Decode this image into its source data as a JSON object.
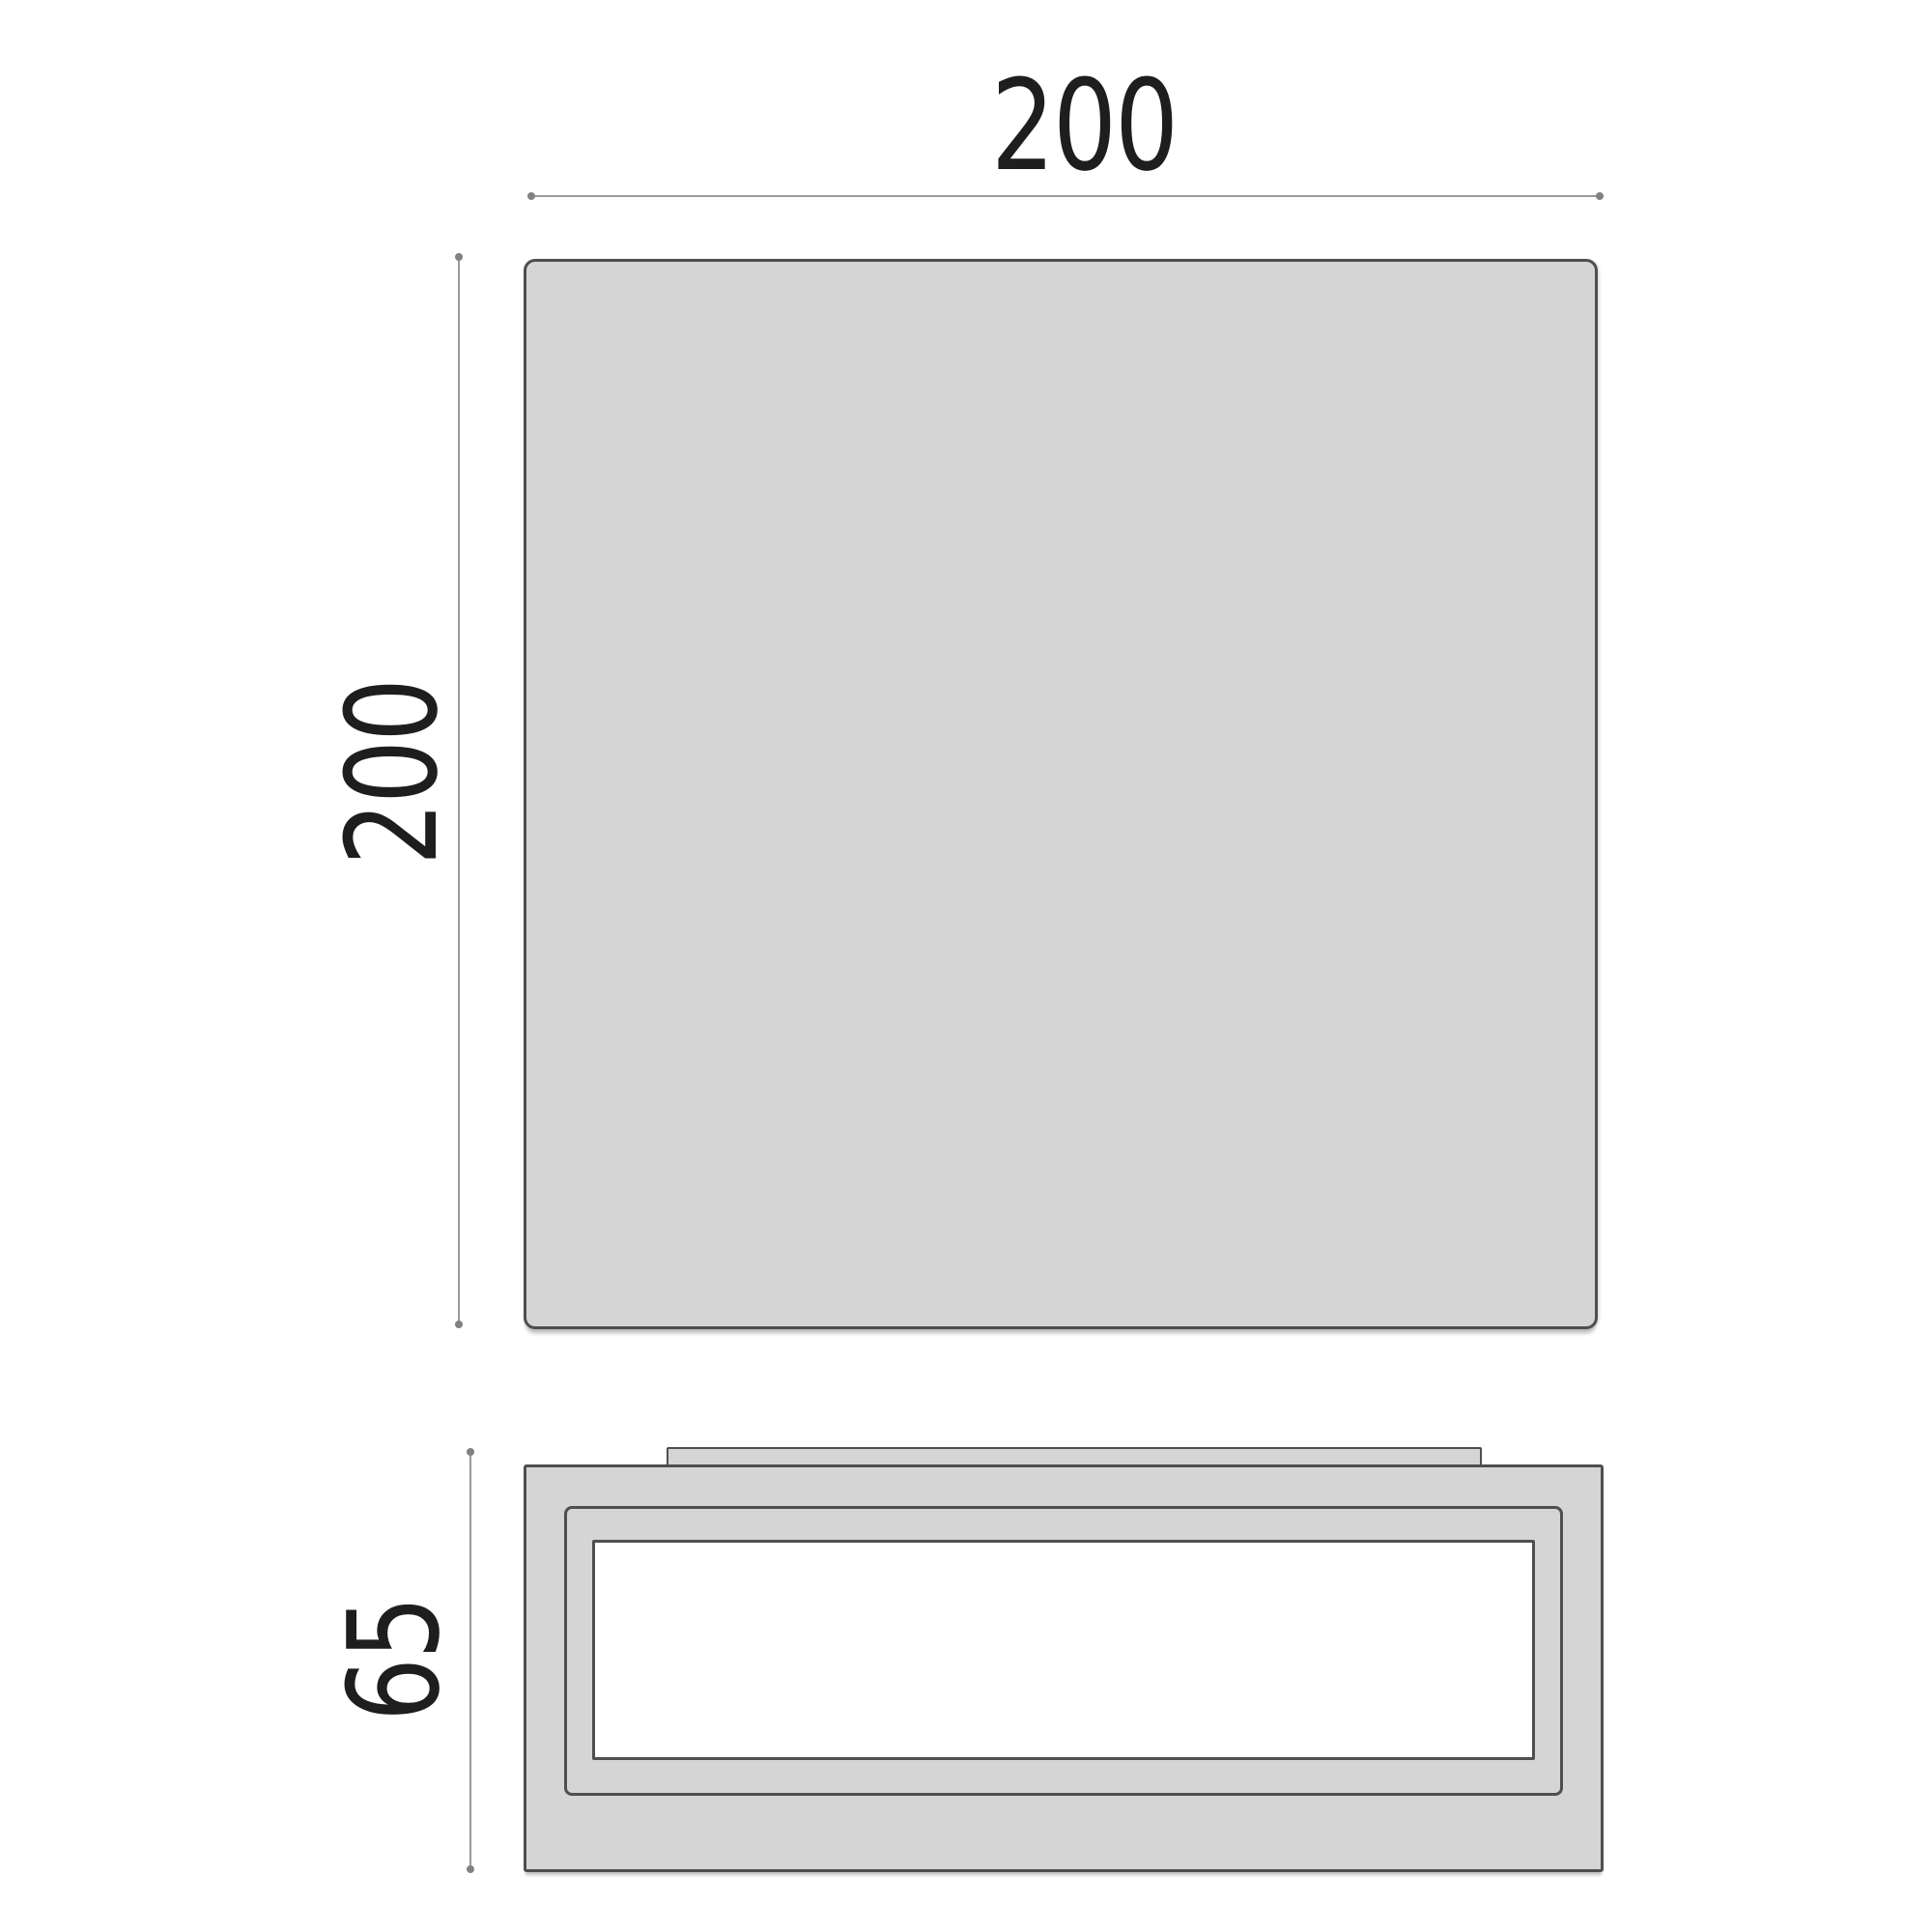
{
  "dimensions": {
    "top_width": "200",
    "top_height": "200",
    "side_height": "65"
  },
  "colors": {
    "background": "#ffffff",
    "shape_fill": "#d5d5d5",
    "outline": "#4f4f4f",
    "dimension_line": "#9a9a9a",
    "dimension_tick": "#818181",
    "label_text": "#1e1e1e",
    "diffuser_fill": "#ffffff"
  }
}
